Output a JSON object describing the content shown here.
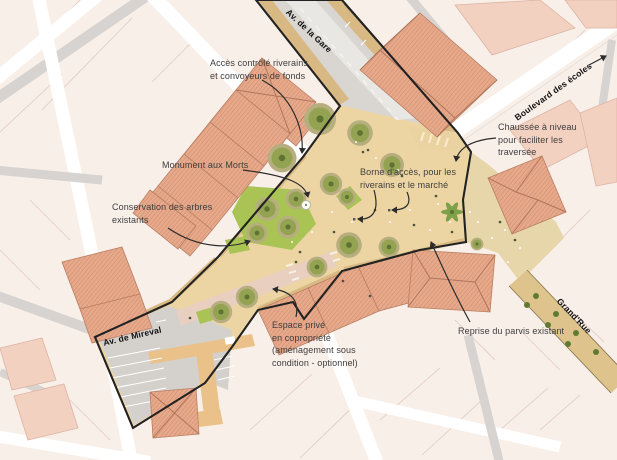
{
  "plan": {
    "streets": {
      "gare": "Av. de la Gare",
      "ecoles": "Boulevard des écoles",
      "grand_rue": "Grand'Rue",
      "mireval": "Av. de Mireval"
    },
    "annotations": {
      "acces": "Accès contrôlé riverains\net convoyeurs de fonds",
      "monument": "Monument aux Morts",
      "conservation": "Conservation des arbres\nexistants",
      "borne": "Borne d'accès, pour les\nriverains et le marché",
      "chaussee": "Chaussée à niveau\npour faciliter les\ntraversée",
      "espace": "Espace privé\nen copropriété\n(aménagement sous\ncondition - optionnel)",
      "reprise": "Reprise du parvis existant"
    },
    "colors": {
      "plaza_tan": "#ecd5a3",
      "sidewalk_tan": "#d8b983",
      "building_salmon": "#e7a98b",
      "building_light": "#f3d1c1",
      "tree_green": "#93a351",
      "lawn_green": "#a9c355",
      "road_gray": "#d6d3d0",
      "parcel_pink": "#f9efe9",
      "outline_black": "#222222"
    }
  }
}
